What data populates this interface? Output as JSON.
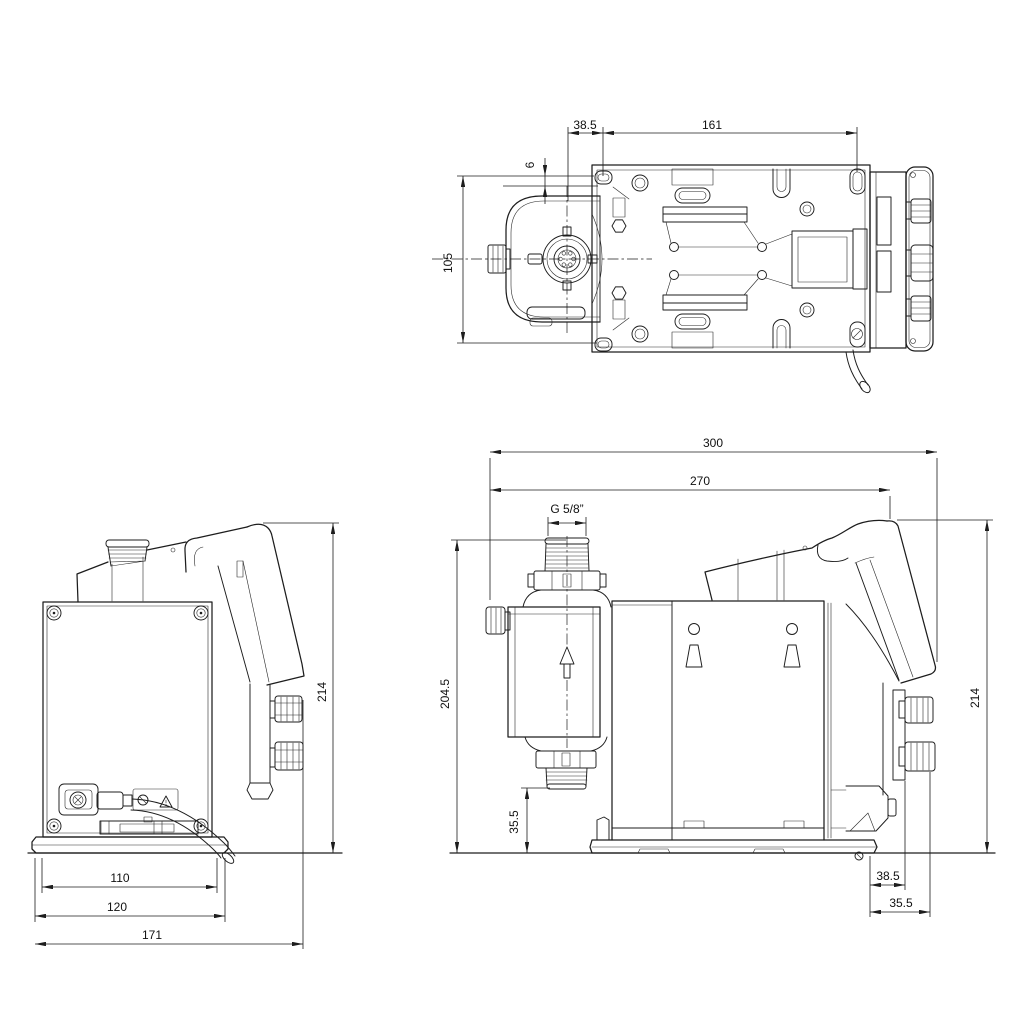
{
  "drawing": {
    "views": {
      "top": {
        "dims": {
          "d38_5": "38.5",
          "d161": "161",
          "d6": "6",
          "d105": "105"
        }
      },
      "front": {
        "dims": {
          "d214": "214",
          "d110": "110",
          "d120": "120",
          "d171": "171"
        }
      },
      "side": {
        "dims": {
          "d300": "300",
          "d270": "270",
          "thread": "G 5/8”",
          "d204_5": "204.5",
          "d35_5_head": "35.5",
          "d214": "214",
          "d38_5": "38.5",
          "d35_5_rear": "35.5"
        }
      }
    },
    "colors": {
      "background": "#ffffff",
      "line": "#1d1d1d",
      "dimension": "#1d1d1d"
    }
  }
}
